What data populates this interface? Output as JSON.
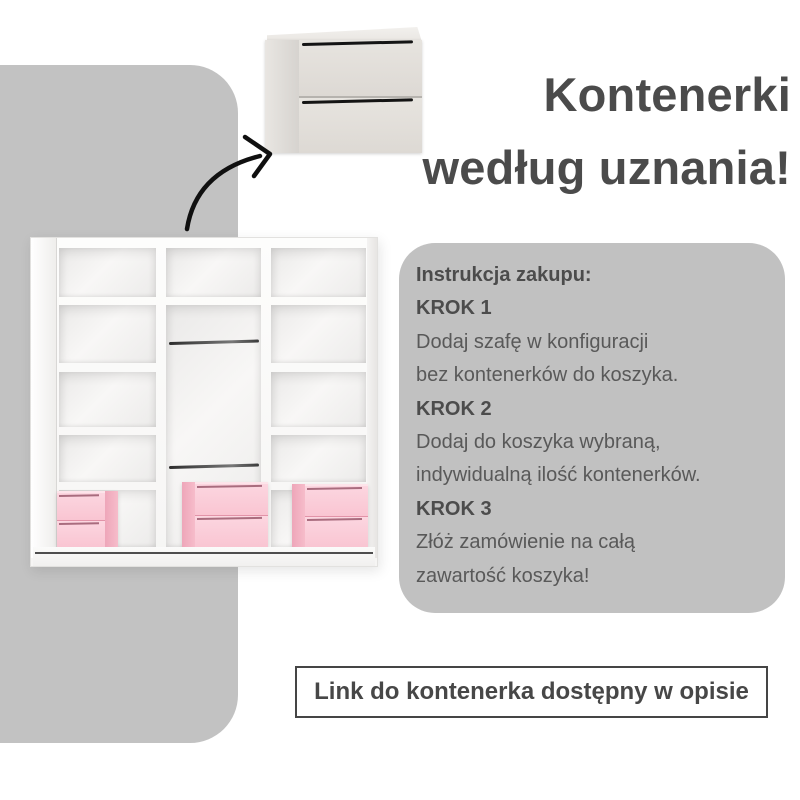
{
  "heading": {
    "line1": "Kontenerki",
    "line2": "według uznania!"
  },
  "instructions": {
    "title": "Instrukcja zakupu:",
    "steps": [
      {
        "label": "KROK 1",
        "lines": [
          "Dodaj szafę w konfiguracji",
          "bez kontenerków do koszyka."
        ]
      },
      {
        "label": "KROK 2",
        "lines": [
          "Dodaj do koszyka wybraną,",
          "indywidualną ilość kontenerków."
        ]
      },
      {
        "label": "KROK 3",
        "lines": [
          "Złóż zamówienie na całą",
          "zawartość koszyka!"
        ]
      }
    ]
  },
  "footer": {
    "link_text": "Link do kontenerka dostępny w opisie"
  },
  "illustration": {
    "container_icon": "two-drawer-container",
    "arrow_icon": "curved-arrow",
    "wardrobe_icon": "open-wardrobe-interior",
    "pink_container_count": 3
  },
  "colors": {
    "background": "#ffffff",
    "panel_gray": "#c2c2c2",
    "instructions_gray": "#c1c1c1",
    "heading_text": "#4b4b4b",
    "body_text": "#595959",
    "bold_text": "#4c4c4c",
    "link_border": "#454545",
    "pink_front": "#fbcfda",
    "pink_side": "#eea6b9",
    "handle_black": "#141414"
  }
}
